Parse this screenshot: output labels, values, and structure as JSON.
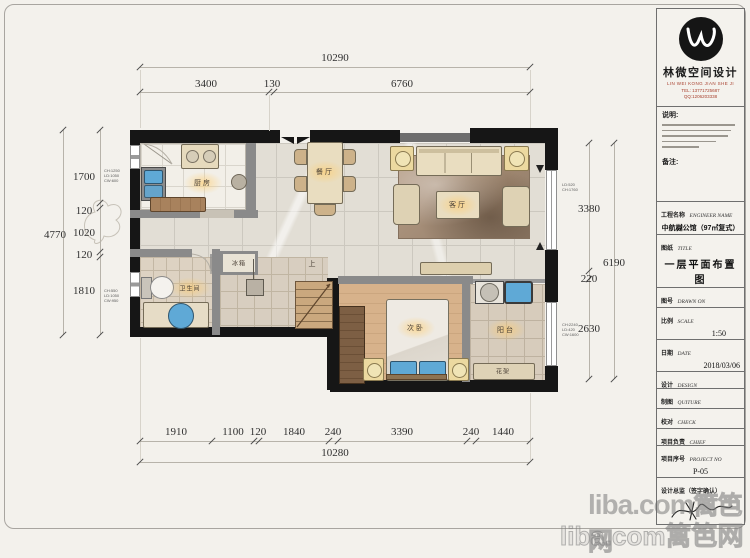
{
  "logo": {
    "brand_cn": "林微空间设计",
    "brand_en": "LIN WEI KONG JIAN SHE JI",
    "tel": "TEL: 13771725687",
    "qq": "QQ:1206203338"
  },
  "titleblock": {
    "notes_heading": "说明:",
    "remarks_heading": "备注:",
    "fields": [
      {
        "label": "工程名称",
        "label_en": "ENGINEER NAME",
        "value": "中航樾公馆（97㎡复式）"
      },
      {
        "label": "图纸",
        "label_en": "TITLE",
        "value": "一层平面布置图"
      },
      {
        "label": "图号",
        "label_en": "DRAWN ON",
        "value": ""
      },
      {
        "label": "比例",
        "label_en": "SCALE",
        "value": "1:50"
      },
      {
        "label": "日期",
        "label_en": "DATE",
        "value": "2018/03/06"
      },
      {
        "label": "设计",
        "label_en": "DESIGN",
        "value": ""
      },
      {
        "label": "制图",
        "label_en": "QUITURE",
        "value": ""
      },
      {
        "label": "校对",
        "label_en": "CHECK",
        "value": ""
      },
      {
        "label": "项目负责",
        "label_en": "CHIEF",
        "value": ""
      },
      {
        "label": "项目序号",
        "label_en": "PROJECT NO",
        "value": "P-05"
      },
      {
        "label": "设计总监（签字确认）",
        "label_en": "",
        "value": ""
      }
    ]
  },
  "rooms": {
    "kitchen": "厨房",
    "dining": "餐厅",
    "living": "客厅",
    "bathroom": "卫生间",
    "fridge": "冰箱",
    "bedroom": "次卧",
    "balcony": "阳台",
    "flower_rack": "花架",
    "stairs_up": "上"
  },
  "dimensions": {
    "top_total": "10290",
    "top_segments": [
      "3400",
      "130",
      "6760"
    ],
    "bottom_segments": [
      "1910",
      "1100",
      "120",
      "1840",
      "240",
      "3390",
      "240",
      "1440"
    ],
    "bottom_total": "10280",
    "left_segments": [
      "1700",
      "120",
      "1020",
      "120",
      "1810"
    ],
    "left_total": "4770",
    "right_segments": [
      "3380",
      "220",
      "2630"
    ],
    "right_total": "6190"
  },
  "annotations": {
    "left_top": [
      "CH:1250",
      "LD:1050",
      "CW:600"
    ],
    "left_bottom": [
      "CH:550",
      "LD:1050",
      "CW:950"
    ],
    "right_top": [
      "LD:520",
      "CH:1760"
    ],
    "right_bottom": [
      "CH:2240",
      "LD:420",
      "CW:1600"
    ]
  },
  "watermark": {
    "line1": "liba.com",
    "line2": "篱笆网"
  },
  "colors": {
    "wall": "#161616",
    "partition": "#8a8a8a",
    "accent_red": "#a8402e",
    "fixture_blue": "#5fa9d6",
    "label_glow": "#ffcd6e"
  }
}
